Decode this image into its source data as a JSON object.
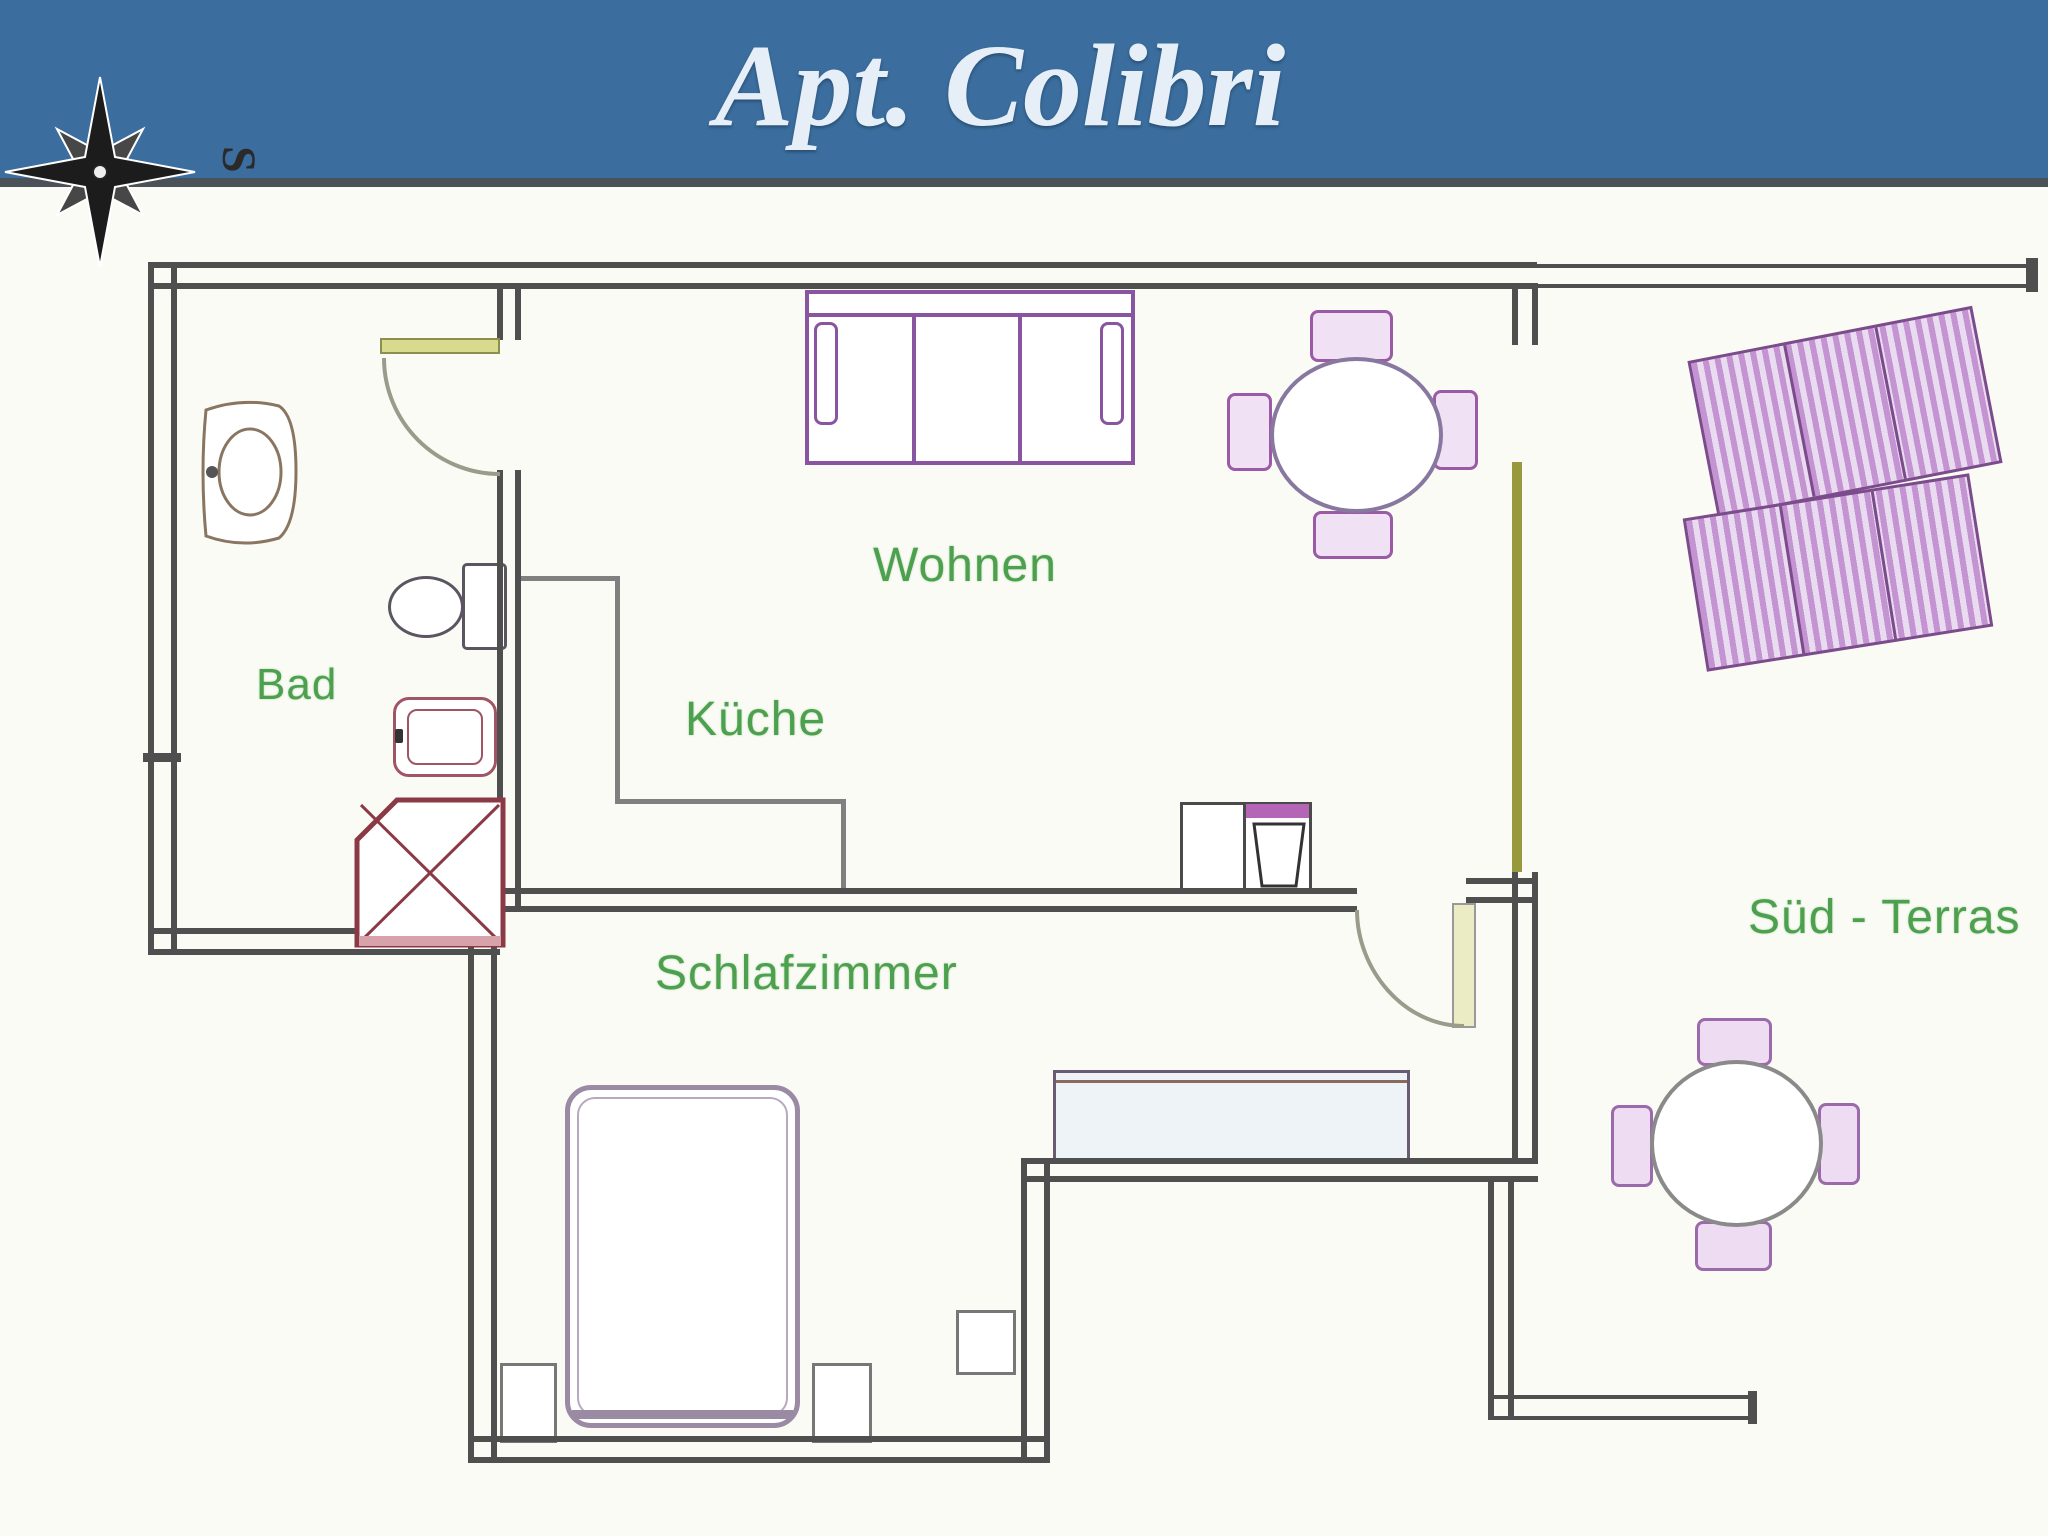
{
  "header": {
    "title": "Apt. Colibri",
    "bg_color": "#3b6e9e",
    "text_color": "#e6eef8",
    "rule_color": "#4b5158"
  },
  "compass": {
    "icon": "compass-rose-icon",
    "south_label": "S"
  },
  "rooms": {
    "bathroom": {
      "label": "Bad"
    },
    "kitchen": {
      "label": "Küche"
    },
    "living": {
      "label": "Wohnen"
    },
    "bedroom": {
      "label": "Schlafzimmer"
    },
    "terrace": {
      "label": "Süd - Terras"
    }
  },
  "fixtures": {
    "bathroom": [
      "washbasin",
      "toilet",
      "bidet",
      "shower"
    ],
    "kitchen": [
      "counter",
      "sink-stove-unit",
      "door-swing"
    ],
    "living": [
      "sofa",
      "round-dining-table",
      "four-chairs",
      "sliding-glass-door"
    ],
    "bedroom": [
      "double-bed",
      "nightstand-left",
      "nightstand-right",
      "side-table",
      "wardrobe",
      "door-swing"
    ],
    "terrace": [
      "sun-lounger-1",
      "sun-lounger-2",
      "round-table",
      "four-chairs",
      "railing"
    ]
  },
  "colors": {
    "wall": "#4f4f4f",
    "room_label_green": "#4da04d",
    "furniture_purple": "#8a55a0",
    "shower_maroon": "#8b3a45",
    "door_leaf_yellow": "#d8da8e",
    "sliding_door_olive": "#97993c",
    "canvas_bg": "#fbfbf6"
  }
}
